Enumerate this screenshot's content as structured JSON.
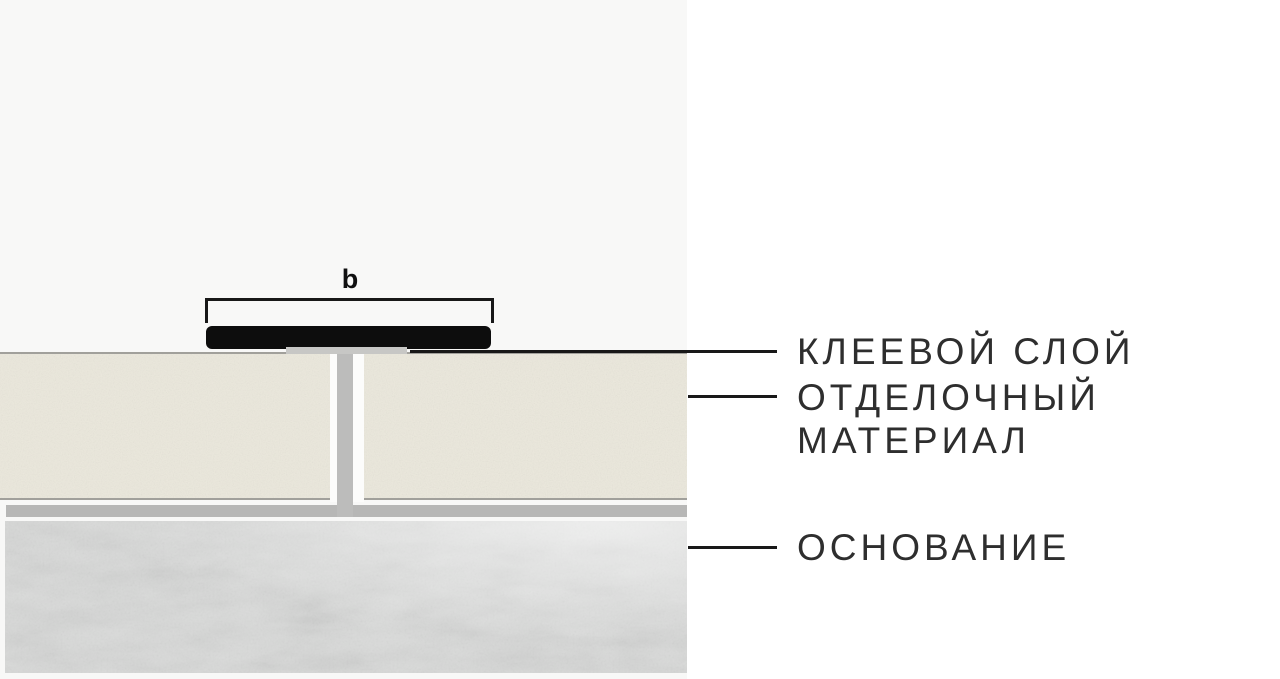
{
  "diagram": {
    "dimension_label": "b",
    "callouts": {
      "adhesive_layer": "КЛЕЕВОЙ СЛОЙ",
      "finishing_material_line1": "ОТДЕЛОЧНЫЙ",
      "finishing_material_line2": "МАТЕРИАЛ",
      "base": "ОСНОВАНИЕ"
    }
  },
  "colors": {
    "page_bg": "#ffffff",
    "panel_bg": "#f8f8f7",
    "profile_black": "#0d0d0d",
    "line_black": "#181818",
    "text_ink": "#2e2e2e",
    "tile_fill": "#ebe8dc",
    "tile_border": "#a1a09b",
    "grout_gray": "#bcbcbb",
    "bed_gray": "#b7b7b6",
    "adhesive_gray": "#c7c7c5",
    "concrete_base": "#d9dad9",
    "gap_white": "#fcfcfb"
  }
}
